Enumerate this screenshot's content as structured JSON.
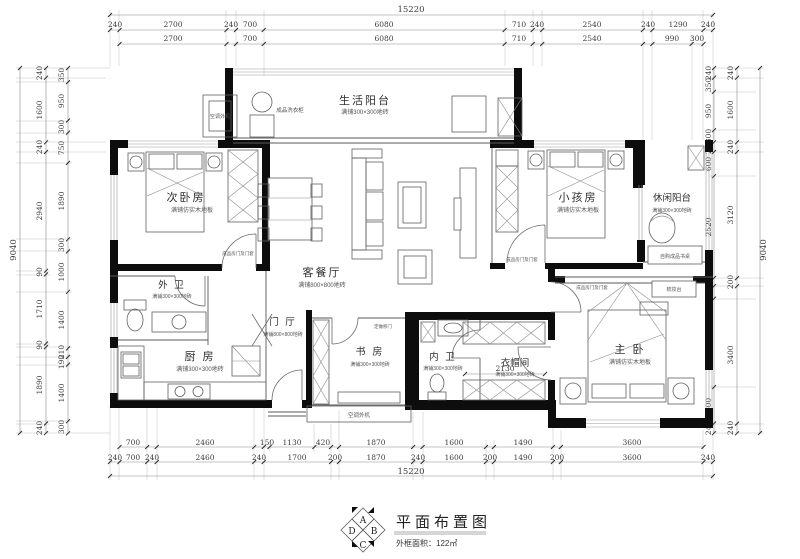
{
  "meta": {
    "title": "平面布置图",
    "area_label": "外框面积：122㎡",
    "compass": {
      "n": "A",
      "e": "B",
      "s": "C",
      "w": "D"
    }
  },
  "dims": {
    "top_total": "15220",
    "bottom_total": "15220",
    "left_total": "9040",
    "right_total": "9040",
    "top_row1": [
      "240",
      "2700",
      "240",
      "700",
      "6080",
      "710",
      "240",
      "2540",
      "240",
      "1290",
      "240"
    ],
    "top_row2": [
      "2700",
      "700",
      "6080",
      "710",
      "2540",
      "990",
      "300"
    ],
    "bottom_row1": [
      "700",
      "2460",
      "150",
      "1130",
      "420",
      "1870",
      "1600",
      "1490",
      "3600"
    ],
    "bottom_row2": [
      "240",
      "700",
      "240",
      "2460",
      "240",
      "1700",
      "200",
      "1870",
      "240",
      "1600",
      "200",
      "1490",
      "200",
      "3600",
      "240"
    ],
    "left_mid": [
      "240",
      "1600",
      "240",
      "2940",
      "90",
      "1710",
      "90",
      "1890",
      "240"
    ],
    "left_inner": [
      "350",
      "950",
      "300",
      "750",
      "1890",
      "300",
      "1000",
      "1400",
      "210",
      "190",
      "1400",
      "300"
    ],
    "right_mid": [
      "240",
      "1600",
      "240",
      "3120",
      "200",
      "3400",
      "240"
    ],
    "right_inner": [
      "240",
      "350",
      "950",
      "300",
      "240",
      "600",
      "2520",
      "200",
      "310",
      "2190",
      "900",
      "240"
    ],
    "cloakroom_width": "2130"
  },
  "rooms": {
    "secondary_bedroom": {
      "name": "次卧房",
      "finish": "满铺仿实木地板"
    },
    "kids_room": {
      "name": "小孩房",
      "finish": "满铺仿实木地板"
    },
    "master_bedroom": {
      "name": "主 卧",
      "finish": "满铺仿实木地板"
    },
    "living_dining": {
      "name": "客餐厅",
      "finish": "满铺800×800地砖"
    },
    "life_balcony": {
      "name": "生活阳台",
      "finish": "满铺300×300地砖"
    },
    "leisure_balcony": {
      "name": "休闲阳台",
      "finish": "满铺300×300地砖"
    },
    "outer_bath": {
      "name": "外 卫",
      "finish": "满铺300×300地砖"
    },
    "inner_bath": {
      "name": "内 卫",
      "finish": "满铺300×300地砖"
    },
    "kitchen": {
      "name": "厨 房",
      "finish": "满铺300×300地砖"
    },
    "study": {
      "name": "书 房",
      "finish": "满铺300×300地砖"
    },
    "foyer": {
      "name": "门 厅",
      "finish": "满铺800×800地砖"
    },
    "cloakroom": {
      "name": "衣帽间",
      "finish": "满铺300×300地砖"
    }
  },
  "annotations": {
    "ac_unit": "空调外机",
    "laundry": "成品洗衣柜",
    "desk": "自购成品书桌",
    "dresser": "梳妆台",
    "door_note": "成品房门及门套",
    "sliding_note": "定做移门"
  }
}
